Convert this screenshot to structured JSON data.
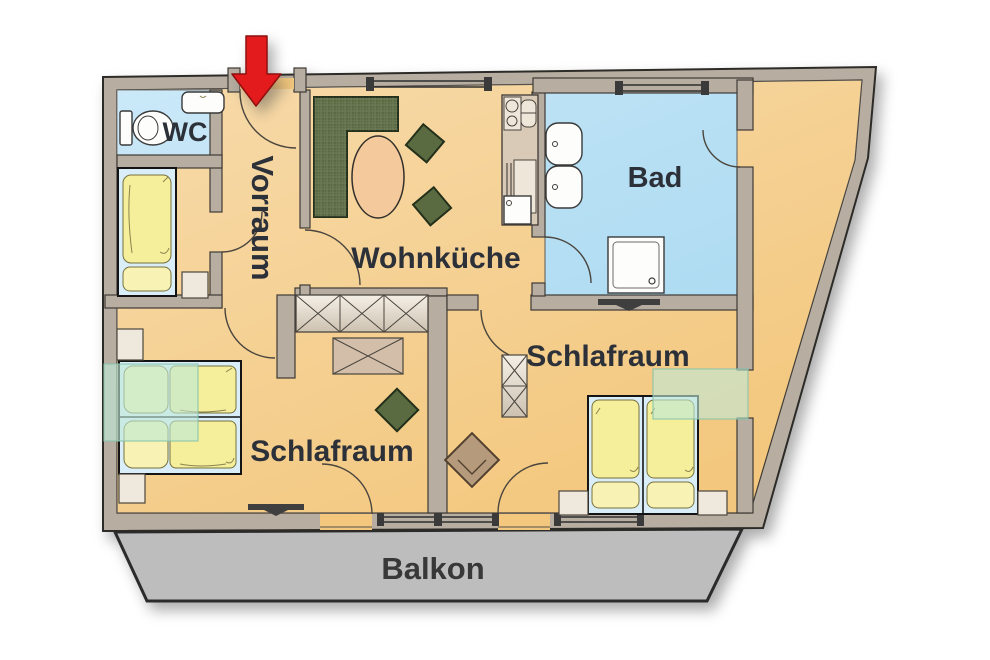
{
  "title": "Wohnungsplan",
  "rooms": {
    "wc": {
      "label": "WC"
    },
    "vorraum": {
      "label": "Vorraum"
    },
    "wohnkueche": {
      "label": "Wohnküche"
    },
    "bad": {
      "label": "Bad"
    },
    "schlafraum_left": {
      "label": "Schlafraum"
    },
    "schlafraum_right": {
      "label": "Schlafraum"
    },
    "balkon": {
      "label": "Balkon"
    }
  },
  "icons": {
    "entrance": "red-down-arrow-entrance-marker"
  },
  "colors": {
    "wall": "#b7aea1",
    "floor": "#f3c77d",
    "wc_blue": "#aedcf4",
    "bad_blue": "#a6d8f1",
    "balcony": "#bdbdbd",
    "accent_red": "#e31b1d",
    "glass_teal": "#bfe9d6",
    "furniture_green": "#5a6b42",
    "table_peach": "#f4c99c",
    "armchair_brown": "#b69a7c",
    "label": "#2c3038"
  }
}
